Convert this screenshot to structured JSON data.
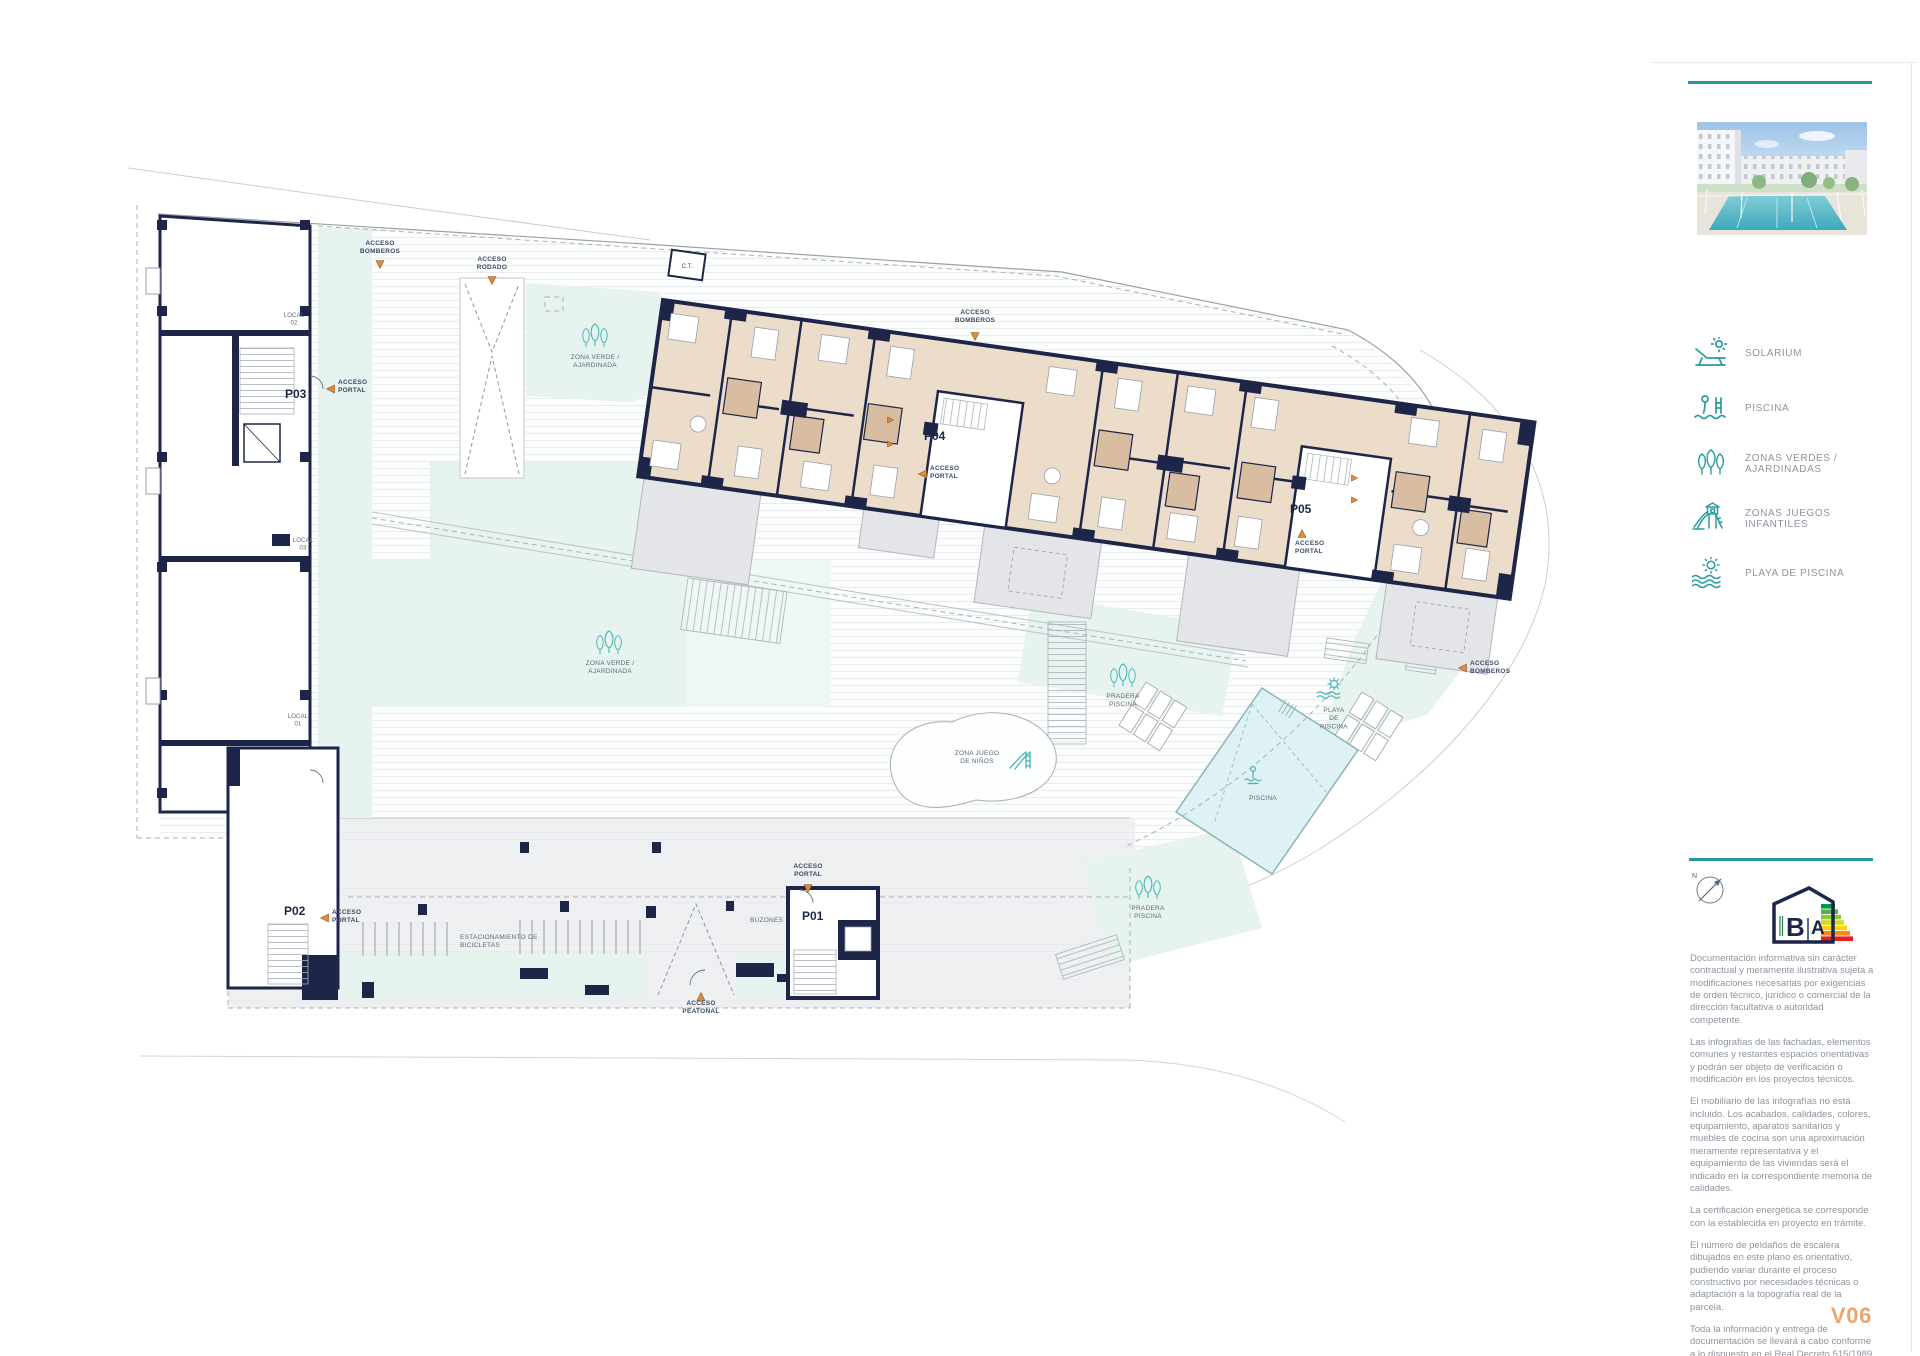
{
  "page": {
    "version_label": "V06"
  },
  "colors": {
    "accent_teal": "#2596a0",
    "icon_teal": "#45b5b8",
    "wall_navy": "#1d2649",
    "access_orange": "#dd8a3f",
    "version_orange": "#eda46a",
    "zone_mint": "#e6f3ee",
    "pool_cyan": "#def1f4",
    "apartment_beige": "#ecdcca"
  },
  "legend": {
    "items": [
      {
        "icon": "solarium-icon",
        "label": "SOLARIUM"
      },
      {
        "icon": "pool-icon",
        "label": "PISCINA"
      },
      {
        "icon": "green-zones-icon",
        "label": "ZONAS VERDES / AJARDINADAS"
      },
      {
        "icon": "playground-icon",
        "label": "ZONAS JUEGOS INFANTILES"
      },
      {
        "icon": "pool-beach-icon",
        "label": "PLAYA DE PISCINA"
      }
    ]
  },
  "compass": {
    "north_label": "N"
  },
  "energy_label": {
    "letter_b": "B",
    "letter_a": "A"
  },
  "disclaimer": {
    "paragraphs": [
      "Documentación informativa sin carácter contractual y meramente ilustrativa sujeta a modificaciones necesarias por exigencias de orden técnico, jurídico o comercial de la dirección facultativa o autoridad competente.",
      "Las infografías de las fachadas, elementos comunes y restantes espacios orientativas y podrán ser objeto de verificación o modificación en los proyectos técnicos.",
      "El mobiliario de las infografías no está incluido. Los acabados, calidades, colores, equipamiento, aparatos sanitarios y muebles de cocina son una aproximación meramente representativa y el equipamiento de las viviendas será el indicado en la correspondiente memoria de calidades.",
      "La certificación energética se corresponde con la establecida en proyecto en trámite.",
      "El número de peldaños de escalera dibujados en este plano es orientativo, pudiendo variar durante el proceso constructivo por necesidades técnicas o adaptación a la topografía real de la parcela.",
      "Toda la información y entrega de documentación se llevará a cabo conforme a lo dispuesto en el Real Decreto 515/1989 y demás normas que pudieran complementarlo ya sean de carácter estatal o autonómico."
    ]
  },
  "plan": {
    "portals": {
      "p01": "P01",
      "p02": "P02",
      "p03": "P03",
      "p04": "P04",
      "p05": "P05"
    },
    "locals": {
      "local01": "LOCAL\n01",
      "local02": "LOCAL\n02",
      "local03": "LOCAL\n03"
    },
    "access": {
      "bomberos": "ACCESO\nBOMBEROS",
      "rodado": "ACCESO\nRODADO",
      "portal": "ACCESO\nPORTAL",
      "peatonal": "ACCESO\nPEATONAL"
    },
    "zones": {
      "zona_verde": "ZONA VERDE /\nAJARDINADA",
      "zona_juego": "ZONA JUEGO\nDE NIÑOS",
      "pradera_piscina": "PRADERA\nPISCINA",
      "playa_piscina": "PLAYA\nDE\nPISCINA",
      "piscina": "PISCINA",
      "estacionamiento": "ESTACIONAMIENTO DE\nBICICLETAS",
      "buzones": "BUZONES",
      "ct": "C.T."
    }
  }
}
